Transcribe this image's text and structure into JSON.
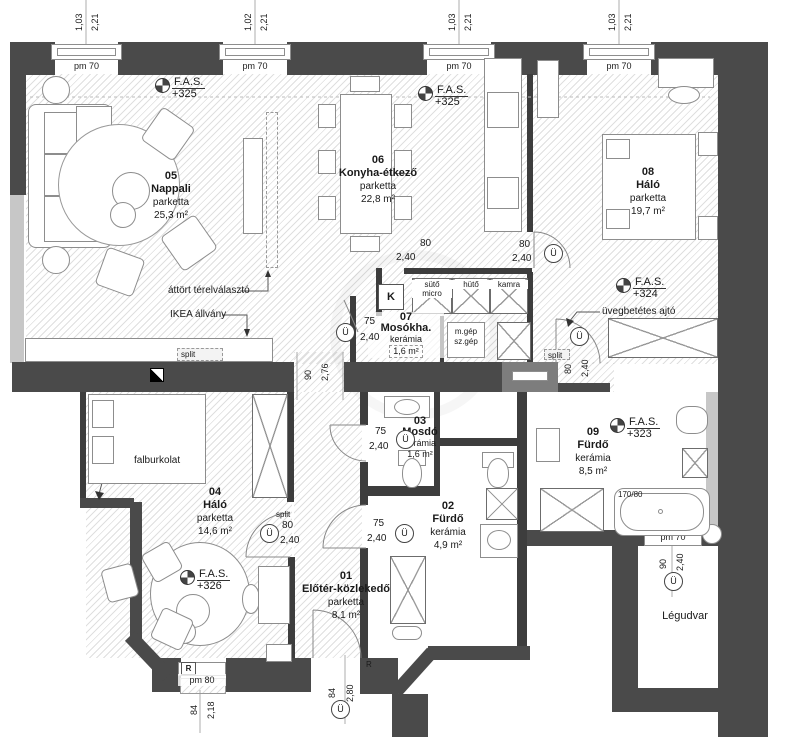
{
  "colors": {
    "wall_dark": "#4a4a4a",
    "wall_light": "#c7c7c7",
    "line": "#6c6c6c",
    "text": "#1a1a1a"
  },
  "rooms": [
    {
      "number": "05",
      "name": "Nappali",
      "material": "parketta",
      "area": "25,3 m²"
    },
    {
      "number": "06",
      "name": "Konyha-étkező",
      "material": "parketta",
      "area": "22,8 m²"
    },
    {
      "number": "08",
      "name": "Háló",
      "material": "parketta",
      "area": "19,7 m²"
    },
    {
      "number": "07",
      "name": "Mosókha.",
      "material": "kerámia",
      "area": "1,6 m²"
    },
    {
      "number": "03",
      "name": "Mosdó",
      "material": "kerámia",
      "area": "1,6 m²"
    },
    {
      "number": "02",
      "name": "Fürdő",
      "material": "kerámia",
      "area": "4,9 m²"
    },
    {
      "number": "09",
      "name": "Fürdő",
      "material": "kerámia",
      "area": "8,5 m²"
    },
    {
      "number": "04",
      "name": "Háló",
      "material": "parketta",
      "area": "14,6 m²"
    },
    {
      "number": "01",
      "name": "Előtér-közlekedő",
      "material": "parketta",
      "area": "8,1 m²"
    }
  ],
  "lightwell": "Légudvar",
  "fas": [
    {
      "label": "F.A.S.",
      "value": "+325"
    },
    {
      "label": "F.A.S.",
      "value": "+325"
    },
    {
      "label": "F.A.S.",
      "value": "+324"
    },
    {
      "label": "F.A.S.",
      "value": "+323"
    },
    {
      "label": "F.A.S.",
      "value": "+326"
    }
  ],
  "windows_top": [
    {
      "label": "pm 70",
      "w": "1,03",
      "h": "2,21"
    },
    {
      "label": "pm 70",
      "w": "1,02",
      "h": "2,21"
    },
    {
      "label": "pm 70",
      "w": "1,03",
      "h": "2,21"
    },
    {
      "label": "pm 70",
      "w": "1,03",
      "h": "2,21"
    }
  ],
  "window_bottom": {
    "marker": "R",
    "label": "pm 80",
    "w": "84",
    "h": "2,18"
  },
  "window_right": {
    "label": "pm 70",
    "w": "90",
    "h": "2,40"
  },
  "dims": [
    {
      "a": "80",
      "b": "2,40"
    },
    {
      "a": "80",
      "b": "2,40"
    },
    {
      "a": "75",
      "b": "2,40"
    },
    {
      "a": "90",
      "b": "2,76"
    },
    {
      "a": "80",
      "b": "2,40"
    },
    {
      "a": "80",
      "b": "2,40"
    },
    {
      "a": "75",
      "b": "2,40"
    },
    {
      "a": "75",
      "b": "2,40"
    },
    {
      "a": "84",
      "b": "2,80"
    }
  ],
  "appliances": {
    "oven_top": "sütő",
    "oven_bottom": "micro",
    "fridge": "hütő",
    "pantry": "kamra",
    "washer_top": "m.gép",
    "washer_bottom": "sz.gép"
  },
  "annotations": {
    "divider": "áttört térelválasztó",
    "shelf": "IKEA állvány",
    "split": "split",
    "wall_cover": "falburkolat",
    "glass_door": "üvegbetétes ajtó",
    "tub_size": "170/80"
  },
  "markers": {
    "k": "K",
    "u": "Ü",
    "r": "R"
  }
}
